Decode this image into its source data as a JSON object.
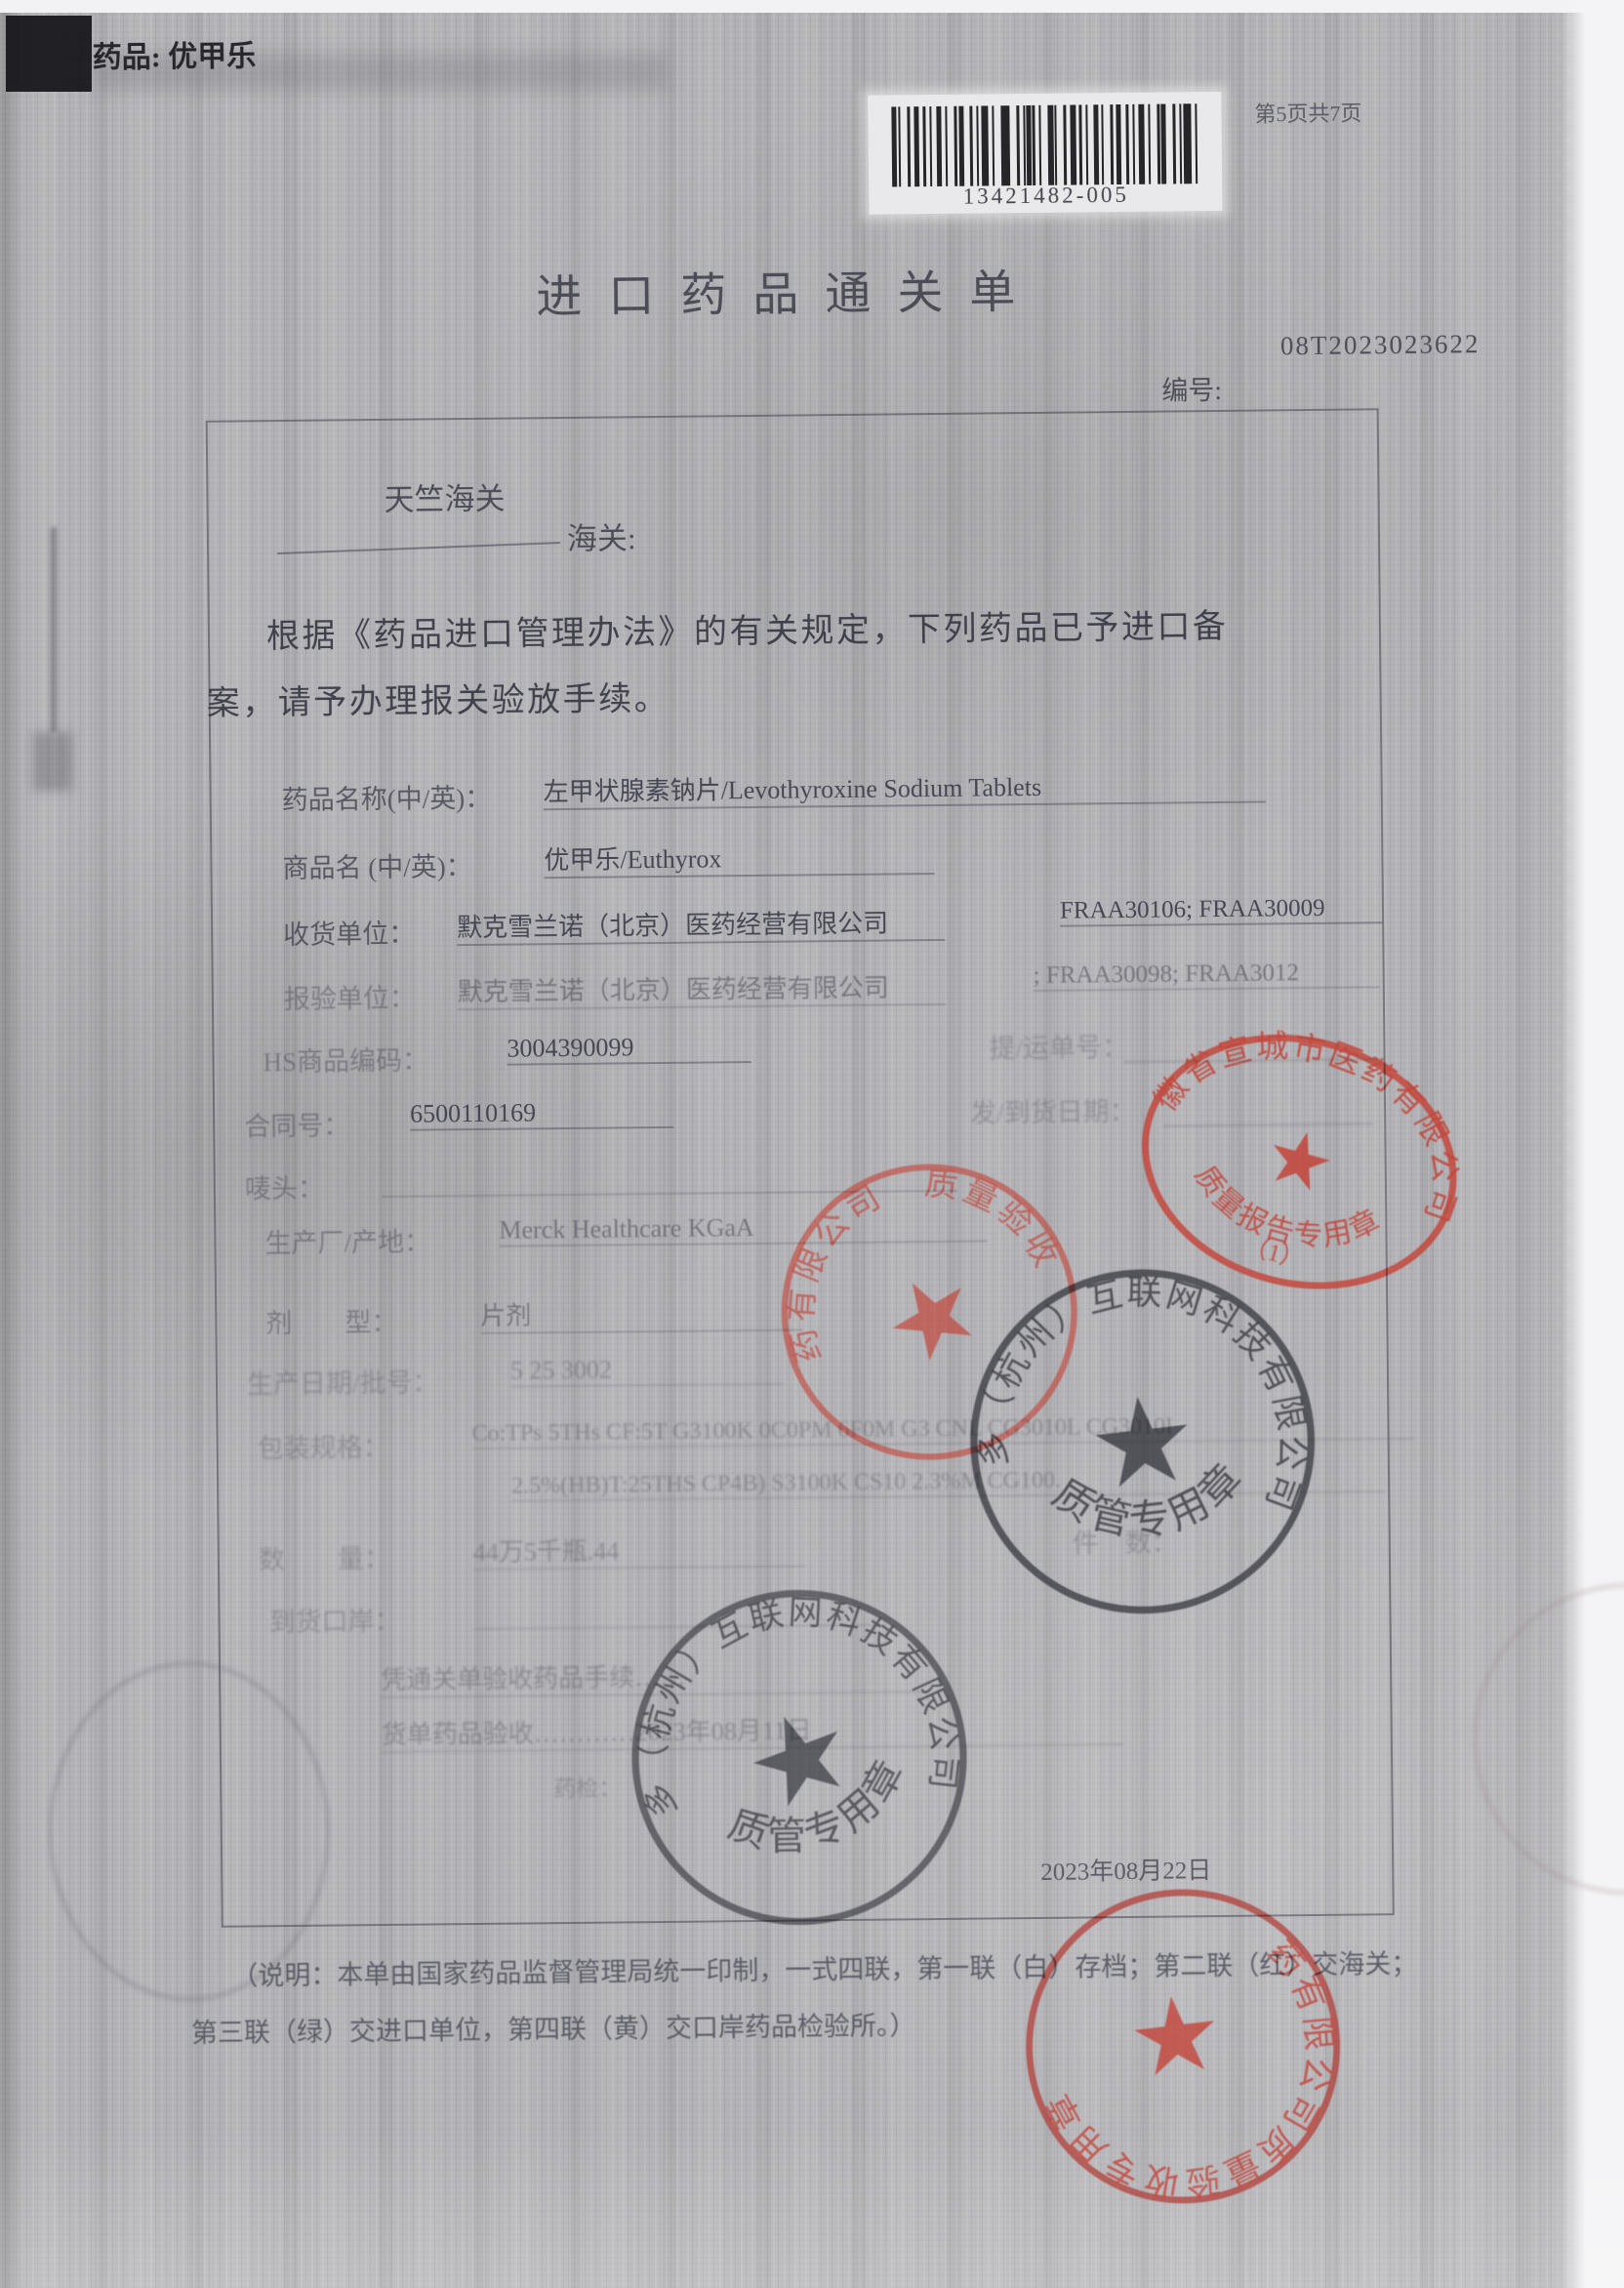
{
  "doc": {
    "corner_label": "药品: 优甲乐",
    "page_indicator": "第5页共7页",
    "barcode_number": "13421482-005",
    "title": "进口药品通关单",
    "serial_number": "08T2023023622",
    "serial_label": "编号:",
    "customs_name": "天竺海关",
    "customs_suffix": "海关:",
    "body_line1": "根据《药品进口管理办法》的有关规定，下列药品已予进口备",
    "body_line2": "案，请予办理报关验放手续。",
    "fields": [
      {
        "label": "药品名称(中/英)：",
        "value": "左甲状腺素钠片/Levothyroxine Sodium Tablets"
      },
      {
        "label": "商品名 (中/英)：",
        "value": "优甲乐/Euthyrox"
      },
      {
        "label": "收货单位：",
        "value": "默克雪兰诺（北京）医药经营有限公司",
        "right": "FRAA30106; FRAA30009"
      },
      {
        "label": "报验单位：",
        "value": "默克雪兰诺（北京）医药经营有限公司",
        "right": "; FRAA30098; FRAA3012"
      },
      {
        "label": "HS商品编码：",
        "value": "3004390099",
        "right": "提/运单号："
      },
      {
        "label": "合同号：",
        "value": "6500110169",
        "right": "发/到货日期："
      },
      {
        "label": "唛头：",
        "value": ""
      },
      {
        "label": "生产厂/产地：",
        "value": "Merck Healthcare KGaA"
      },
      {
        "label": "剂　　型：",
        "value": "片剂"
      },
      {
        "label": "生产日期/批号：",
        "value": "5 25 3002"
      },
      {
        "label": "包装规格：",
        "value": "Co:TPs 5THs CF:5T G3100K 0C0PM 6F0M G3 CNL CG3010L CG3010I",
        "value2": "2.5%(HB)T:25THS CP4B) S3100K CS10 2.3%M CG100."
      },
      {
        "label": "数　　量：",
        "value": "44万5千瓶.44",
        "right": "件　数："
      },
      {
        "label": "到货口岸：",
        "value": ""
      },
      {
        "label": "",
        "value": "凭通关单验收药品手续……"
      },
      {
        "label": "",
        "value": "货单药品验收…………2023年08月11日"
      },
      {
        "label": "药检：",
        "value": ""
      }
    ],
    "date_line": "2023年08月22日",
    "footer_line1": "（说明：本单由国家药品监督管理局统一印制，一式四联，第一联（白）存档；第二联（红）交海关；",
    "footer_line2": "第三联（绿）交进口单位，第四联（黄）交口岸药品检验所。）",
    "stamps": {
      "star": "★",
      "red1": {
        "ring": "安徽省宣城市医药有限公司",
        "bottom": "质量报告专用章",
        "sub": "（1）"
      },
      "red2": {
        "ring": "医药有限公司　质量验收"
      },
      "black": {
        "ring": "哈多多（杭州）互联网科技有限公司",
        "bottom": "质管专用章"
      },
      "red3": {
        "ring": "医药有限公司质量验收专用章"
      }
    }
  }
}
